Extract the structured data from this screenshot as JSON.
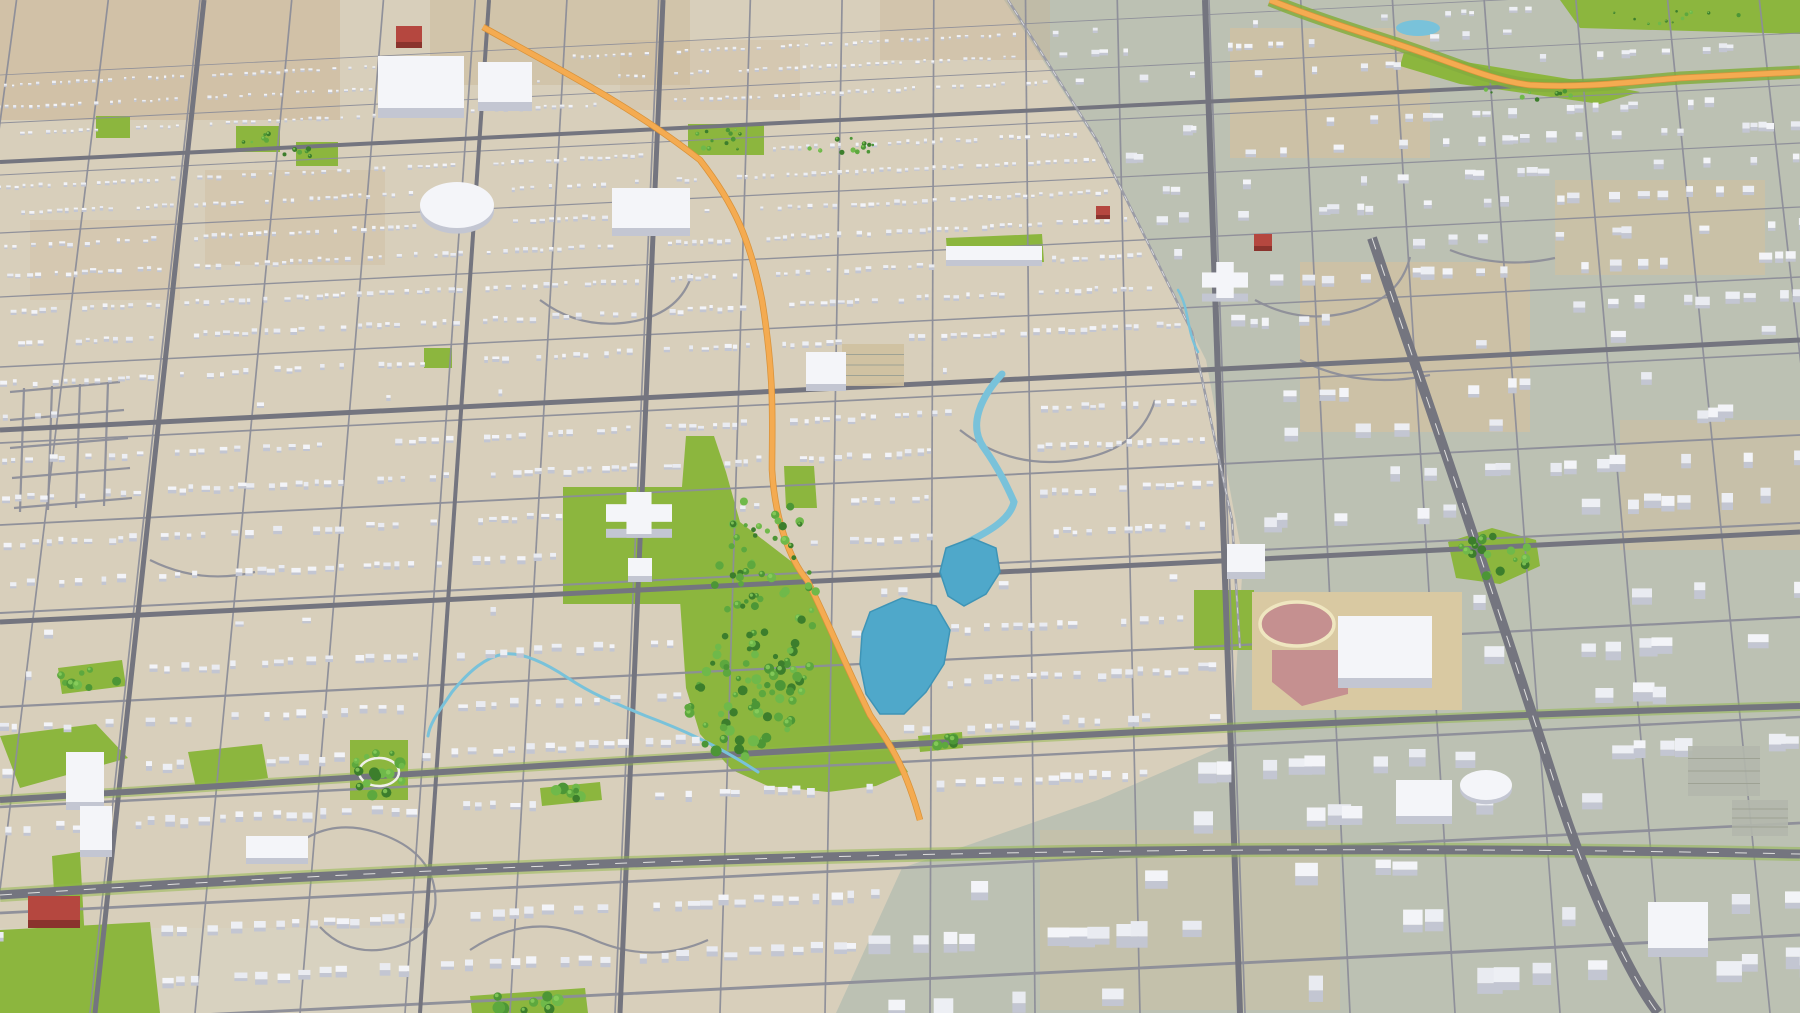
{
  "scene": {
    "canvas": {
      "width": 1800,
      "height": 1013
    },
    "colors": {
      "ground": "#d8cfbb",
      "sage": "#bcc1b3",
      "road_minor": "#8d8e99",
      "road_major": "#74757f",
      "rail": "#9b9ca6",
      "lane_dash": "#f2f2ee",
      "orange": "#f4ab51",
      "orange_edge": "#d8923a",
      "verge": "#8fb84a",
      "park": "#8cb63e",
      "lawn": "#7bb237",
      "tree_palette": [
        "#3c7e2c",
        "#4c9636",
        "#5da83e",
        "#6fb94a"
      ],
      "tree_highlight": "#8ccf5e",
      "lake": "#4fa8ca",
      "lake_edge": "#3e94b6",
      "creek": "#79c2da",
      "building_tops": [
        "#f3f4f8",
        "#edeff4",
        "#e9ebf1"
      ],
      "building_face": "#c3c6d2",
      "red": "#b5473f",
      "red_face": "#8a332d",
      "school_apron": "#d9c9a2",
      "track_ring": "#efe6c0",
      "field_pink": "#c59090",
      "lot_gray": "#b3b7ac",
      "lot_tan": "#cfc0a0",
      "court_ring": "#f0f0ea"
    },
    "ground": {
      "sage_polygon": [
        1004,
        0,
        1800,
        0,
        1800,
        1013,
        836,
        1013,
        902,
        868,
        1098,
        800,
        1232,
        742,
        1243,
        560,
        1206,
        360,
        1096,
        142
      ],
      "patches": [
        {
          "x": 0,
          "y": 0,
          "w": 340,
          "h": 120,
          "fill": "#c9b493",
          "op": 0.5
        },
        {
          "x": 430,
          "y": 0,
          "w": 260,
          "h": 85,
          "fill": "#c9b493",
          "op": 0.42
        },
        {
          "x": 880,
          "y": 0,
          "w": 170,
          "h": 60,
          "fill": "#c9b493",
          "op": 0.38
        },
        {
          "x": 205,
          "y": 170,
          "w": 180,
          "h": 95,
          "fill": "#cdb896",
          "op": 0.32
        },
        {
          "x": 30,
          "y": 220,
          "w": 150,
          "h": 80,
          "fill": "#cdb896",
          "op": 0.28
        },
        {
          "x": 620,
          "y": 40,
          "w": 180,
          "h": 70,
          "fill": "#cdb896",
          "op": 0.28
        },
        {
          "x": 1230,
          "y": 28,
          "w": 200,
          "h": 130,
          "fill": "#cfc0a2",
          "op": 0.8
        },
        {
          "x": 1300,
          "y": 262,
          "w": 230,
          "h": 170,
          "fill": "#cfc0a2",
          "op": 0.8
        },
        {
          "x": 1555,
          "y": 180,
          "w": 210,
          "h": 95,
          "fill": "#cfc0a2",
          "op": 0.7
        },
        {
          "x": 1620,
          "y": 420,
          "w": 180,
          "h": 130,
          "fill": "#cfc0a2",
          "op": 0.6
        },
        {
          "x": 1040,
          "y": 830,
          "w": 300,
          "h": 180,
          "fill": "#cfc0a2",
          "op": 0.45
        },
        {
          "x": 0,
          "y": 928,
          "w": 430,
          "h": 85,
          "fill": "#d9d3c2",
          "op": 0.7
        }
      ]
    },
    "perspective": {
      "vp_x": 960,
      "vp_y": -7000,
      "row_slope": -0.05,
      "row_ys": [
        30,
        78,
        130,
        188,
        252,
        322,
        398,
        480,
        568,
        662,
        762,
        868,
        980,
        1100
      ],
      "col_xs_bottom": [
        -120,
        -15,
        90,
        195,
        300,
        405,
        510,
        615,
        720,
        825,
        930,
        1035,
        1140,
        1245,
        1350,
        1455,
        1560,
        1665,
        1770,
        1875
      ],
      "sub_rows": [
        0.22,
        0.68
      ]
    },
    "roads": {
      "major": [
        {
          "path": "M204,0 L95,1013",
          "w": 5
        },
        {
          "path": "M489,0 L420,1013",
          "w": 4
        },
        {
          "path": "M663,0 L620,1013",
          "w": 5
        },
        {
          "path": "M1205,0 L1240,1013",
          "w": 6
        },
        {
          "path": "M0,162 L1800,72",
          "w": 4
        },
        {
          "path": "M0,430 L1800,340",
          "w": 5
        },
        {
          "path": "M0,622 L1800,532",
          "w": 5
        },
        {
          "path": "M0,800 C600,762 1200,722 1800,706",
          "w": 6,
          "verge": 10
        }
      ],
      "dashed_major": [
        {
          "path": "M0,895 C500,862 1100,840 1800,854",
          "w": 9,
          "verge": 14
        },
        {
          "path": "M1372,238 C1420,380 1470,520 1560,800 C1600,920 1640,990 1658,1013",
          "w": 10
        }
      ],
      "rail": [
        {
          "path": "M1008,0 L1098,142 L1192,332 L1232,520 L1240,648",
          "w": 2.5
        }
      ],
      "curvy": [
        "M280,860 q40,-45 95,-28 q55,17 60,60 q5,42 -40,55 q-45,12 -75,-20",
        "M470,950 q60,-40 120,-12 q60,28 118,2",
        "M1255,300 q45,25 95,12 q50,-13 60,-55",
        "M1300,360 q60,30 130,15",
        "M960,430 q50,40 115,30 q65,-10 80,-60",
        "M540,300 q40,30 90,22 q50,-8 62,-48",
        "M150,560 q50,25 105,12",
        "M1450,250 q50,20 105,8",
        "M10,392 L120,382",
        "M10,420 L124,410",
        "M10,448 L128,438",
        "M12,478 L130,468",
        "M14,508 L132,498",
        "M24,388 L20,512",
        "M52,386 L48,510",
        "M80,384 L76,508",
        "M108,382 L104,506"
      ]
    },
    "orange_highways": [
      {
        "path": "M483,27 C560,70 630,105 700,160 C735,205 750,240 762,300 C775,380 772,420 772,470 C775,520 790,560 807,580 C825,615 843,660 870,715 C890,745 905,765 920,820",
        "verge": 0
      },
      {
        "path": "M1270,0 C1320,20 1370,35 1400,45 C1460,65 1490,80 1530,85 C1580,88 1620,83 1680,78 L1800,72",
        "verge": 13
      }
    ],
    "water": {
      "lakes": [
        [
          870,
          612,
          902,
          598,
          936,
          606,
          950,
          630,
          944,
          664,
          926,
          692,
          904,
          714,
          880,
          714,
          866,
          694,
          860,
          664,
          862,
          634
        ],
        [
          946,
          548,
          972,
          538,
          996,
          548,
          1000,
          572,
          986,
          594,
          964,
          606,
          948,
          596,
          940,
          572
        ]
      ],
      "ponds": [
        {
          "cx": 1418,
          "cy": 28,
          "rx": 22,
          "ry": 8
        }
      ],
      "streams": [
        {
          "path": "M1002,374 C980,398 968,426 984,448 C998,468 1006,484 1014,502 C1010,520 988,532 964,544",
          "w": 7
        },
        {
          "path": "M758,772 C716,744 678,728 646,716 C612,702 592,694 568,678 C544,662 522,652 504,654 C486,657 470,670 452,692 C440,710 430,722 428,736",
          "w": 3
        },
        {
          "path": "M1178,290 C1190,310 1186,330 1198,352",
          "w": 2.5
        }
      ]
    },
    "parks": [
      [
        563,
        487,
        688,
        487,
        688,
        604,
        563,
        604
      ],
      [
        686,
        436,
        714,
        436,
        726,
        472,
        740,
        522,
        792,
        562,
        822,
        612,
        845,
        657,
        872,
        716,
        893,
        748,
        908,
        772,
        876,
        786,
        828,
        792,
        768,
        786,
        732,
        770,
        700,
        734,
        686,
        688,
        680,
        600,
        680,
        512
      ],
      [
        784,
        466,
        814,
        466,
        817,
        508,
        786,
        508
      ],
      [
        688,
        124,
        764,
        124,
        764,
        155,
        688,
        155
      ],
      [
        96,
        116,
        130,
        116,
        130,
        138,
        96,
        138
      ],
      [
        236,
        126,
        280,
        126,
        280,
        152,
        236,
        152
      ],
      [
        296,
        142,
        338,
        142,
        338,
        166,
        296,
        166
      ],
      [
        424,
        348,
        452,
        348,
        452,
        368,
        424,
        368
      ],
      [
        1194,
        590,
        1254,
        590,
        1254,
        650,
        1194,
        650
      ],
      [
        350,
        740,
        408,
        740,
        408,
        800,
        350,
        800
      ],
      [
        1448,
        542,
        1492,
        528,
        1536,
        540,
        1540,
        566,
        1500,
        584,
        1456,
        578
      ],
      [
        0,
        736,
        96,
        724,
        128,
        758,
        20,
        788
      ],
      [
        188,
        752,
        262,
        744,
        268,
        778,
        196,
        788
      ],
      [
        0,
        930,
        150,
        922,
        160,
        1013,
        0,
        1013
      ],
      [
        52,
        856,
        80,
        852,
        86,
        960,
        58,
        964
      ],
      [
        58,
        668,
        122,
        660,
        126,
        686,
        62,
        694
      ],
      [
        540,
        788,
        600,
        782,
        602,
        800,
        542,
        806
      ],
      [
        918,
        736,
        962,
        732,
        963,
        748,
        920,
        752
      ],
      [
        470,
        996,
        585,
        988,
        588,
        1013,
        472,
        1013
      ],
      [
        1560,
        0,
        1800,
        0,
        1800,
        34,
        1580,
        28
      ],
      [
        1404,
        52,
        1600,
        84,
        1640,
        92,
        1600,
        104,
        1460,
        84,
        1400,
        66
      ],
      [
        946,
        238,
        1042,
        234,
        1044,
        262,
        948,
        266
      ]
    ],
    "tree_clusters": [
      {
        "cx": 765,
        "cy": 610,
        "rx": 52,
        "ry": 120,
        "n": 85
      },
      {
        "cx": 742,
        "cy": 706,
        "rx": 55,
        "ry": 60,
        "n": 45
      },
      {
        "cx": 378,
        "cy": 770,
        "rx": 26,
        "ry": 26,
        "n": 18
      },
      {
        "cx": 1492,
        "cy": 556,
        "rx": 40,
        "ry": 22,
        "n": 20
      },
      {
        "cx": 724,
        "cy": 140,
        "rx": 34,
        "ry": 13,
        "n": 12
      },
      {
        "cx": 842,
        "cy": 146,
        "rx": 40,
        "ry": 10,
        "n": 12
      },
      {
        "cx": 88,
        "cy": 678,
        "rx": 30,
        "ry": 11,
        "n": 8
      },
      {
        "cx": 568,
        "cy": 794,
        "rx": 28,
        "ry": 8,
        "n": 7
      },
      {
        "cx": 940,
        "cy": 742,
        "rx": 20,
        "ry": 7,
        "n": 6
      },
      {
        "cx": 525,
        "cy": 1002,
        "rx": 52,
        "ry": 9,
        "n": 9
      },
      {
        "cx": 302,
        "cy": 154,
        "rx": 18,
        "ry": 8,
        "n": 6
      },
      {
        "cx": 255,
        "cy": 139,
        "rx": 20,
        "ry": 9,
        "n": 6
      },
      {
        "cx": 1680,
        "cy": 14,
        "rx": 70,
        "ry": 11,
        "n": 12
      },
      {
        "cx": 1520,
        "cy": 92,
        "rx": 60,
        "ry": 9,
        "n": 9
      }
    ],
    "court_rings": [
      {
        "cx": 379,
        "cy": 772,
        "rx": 20,
        "ry": 14
      }
    ],
    "school_complex": {
      "apron": {
        "x": 1252,
        "y": 592,
        "w": 210,
        "h": 118
      },
      "track": {
        "cx": 1297,
        "cy": 624,
        "rx": 37,
        "ry": 22
      },
      "diamond": [
        1272,
        650,
        1348,
        650,
        1348,
        694,
        1302,
        706,
        1272,
        682
      ]
    },
    "landmarks": [
      {
        "t": "lot",
        "x": 842,
        "y": 344,
        "w": 62,
        "h": 42,
        "c": "lot_tan"
      },
      {
        "t": "lot",
        "x": 1688,
        "y": 746,
        "w": 72,
        "h": 50,
        "c": "lot_gray"
      },
      {
        "t": "lot",
        "x": 1732,
        "y": 800,
        "w": 56,
        "h": 36,
        "c": "lot_gray"
      },
      {
        "t": "rect",
        "x": 378,
        "y": 56,
        "w": 86,
        "h": 52,
        "lift": 10
      },
      {
        "t": "rect",
        "x": 478,
        "y": 62,
        "w": 54,
        "h": 40,
        "lift": 9
      },
      {
        "t": "ellipse",
        "x": 420,
        "y": 182,
        "w": 74,
        "h": 46,
        "lift": 8
      },
      {
        "t": "rect",
        "x": 612,
        "y": 188,
        "w": 78,
        "h": 40,
        "lift": 8
      },
      {
        "t": "rect",
        "x": 806,
        "y": 352,
        "w": 40,
        "h": 32,
        "lift": 7
      },
      {
        "t": "cross",
        "x": 606,
        "y": 492,
        "w": 66,
        "h": 42,
        "lift": 9
      },
      {
        "t": "rect",
        "x": 628,
        "y": 558,
        "w": 24,
        "h": 18,
        "lift": 6
      },
      {
        "t": "rect",
        "x": 1338,
        "y": 616,
        "w": 94,
        "h": 62,
        "lift": 10
      },
      {
        "t": "rect",
        "x": 1227,
        "y": 544,
        "w": 38,
        "h": 28,
        "lift": 7
      },
      {
        "t": "cross",
        "x": 1202,
        "y": 262,
        "w": 46,
        "h": 36,
        "lift": 8
      },
      {
        "t": "rect",
        "x": 1396,
        "y": 780,
        "w": 56,
        "h": 36,
        "lift": 8
      },
      {
        "t": "ellipse",
        "x": 1460,
        "y": 770,
        "w": 52,
        "h": 30,
        "lift": 6
      },
      {
        "t": "rect",
        "x": 66,
        "y": 752,
        "w": 38,
        "h": 50,
        "lift": 8
      },
      {
        "t": "rect",
        "x": 80,
        "y": 806,
        "w": 32,
        "h": 44,
        "lift": 7
      },
      {
        "t": "rect",
        "x": 246,
        "y": 836,
        "w": 62,
        "h": 22,
        "lift": 6
      },
      {
        "t": "rect",
        "x": 1648,
        "y": 902,
        "w": 60,
        "h": 46,
        "lift": 9
      },
      {
        "t": "rect",
        "x": 946,
        "y": 246,
        "w": 96,
        "h": 14,
        "lift": 6
      },
      {
        "t": "rect",
        "x": 28,
        "y": 896,
        "w": 52,
        "h": 24,
        "lift": 8,
        "c": "red"
      },
      {
        "t": "rect",
        "x": 396,
        "y": 26,
        "w": 26,
        "h": 16,
        "lift": 6,
        "c": "red"
      },
      {
        "t": "rect",
        "x": 1254,
        "y": 234,
        "w": 18,
        "h": 12,
        "lift": 5,
        "c": "red"
      },
      {
        "t": "rect",
        "x": 1096,
        "y": 206,
        "w": 14,
        "h": 9,
        "lift": 4,
        "c": "red"
      }
    ],
    "generation": {
      "seed": 1337,
      "keep_probability": 0.8,
      "sage_keep": 0.3,
      "sage_size_mult": 2.0,
      "scale_near": 1.47,
      "scale_far": 0.42
    },
    "avoid_lines": [
      {
        "d": 11,
        "pts": [
          [
            483,
            27
          ],
          [
            630,
            105
          ],
          [
            700,
            160
          ],
          [
            745,
            230
          ],
          [
            762,
            300
          ],
          [
            772,
            420
          ],
          [
            790,
            560
          ],
          [
            820,
            620
          ],
          [
            860,
            700
          ],
          [
            905,
            768
          ],
          [
            920,
            820
          ]
        ]
      },
      {
        "d": 11,
        "pts": [
          [
            1270,
            0
          ],
          [
            1400,
            45
          ],
          [
            1530,
            85
          ],
          [
            1800,
            72
          ]
        ]
      },
      {
        "d": 13,
        "pts": [
          [
            1372,
            238
          ],
          [
            1470,
            520
          ],
          [
            1560,
            800
          ],
          [
            1658,
            1013
          ]
        ]
      },
      {
        "d": 12,
        "pts": [
          [
            0,
            895
          ],
          [
            500,
            862
          ],
          [
            1100,
            840
          ],
          [
            1800,
            854
          ]
        ]
      },
      {
        "d": 7,
        "pts": [
          [
            204,
            0
          ],
          [
            95,
            1013
          ]
        ]
      },
      {
        "d": 7,
        "pts": [
          [
            663,
            0
          ],
          [
            620,
            1013
          ]
        ]
      },
      {
        "d": 7,
        "pts": [
          [
            1205,
            0
          ],
          [
            1240,
            1013
          ]
        ]
      },
      {
        "d": 6,
        "pts": [
          [
            489,
            0
          ],
          [
            420,
            1013
          ]
        ]
      },
      {
        "d": 6,
        "pts": [
          [
            0,
            162
          ],
          [
            1800,
            72
          ]
        ]
      },
      {
        "d": 7,
        "pts": [
          [
            0,
            430
          ],
          [
            1800,
            340
          ]
        ]
      },
      {
        "d": 7,
        "pts": [
          [
            0,
            622
          ],
          [
            1800,
            532
          ]
        ]
      },
      {
        "d": 8,
        "pts": [
          [
            0,
            800
          ],
          [
            900,
            755
          ],
          [
            1800,
            706
          ]
        ]
      },
      {
        "d": 6,
        "pts": [
          [
            1008,
            0
          ],
          [
            1098,
            142
          ],
          [
            1192,
            332
          ],
          [
            1232,
            520
          ],
          [
            1240,
            648
          ]
        ]
      }
    ]
  }
}
